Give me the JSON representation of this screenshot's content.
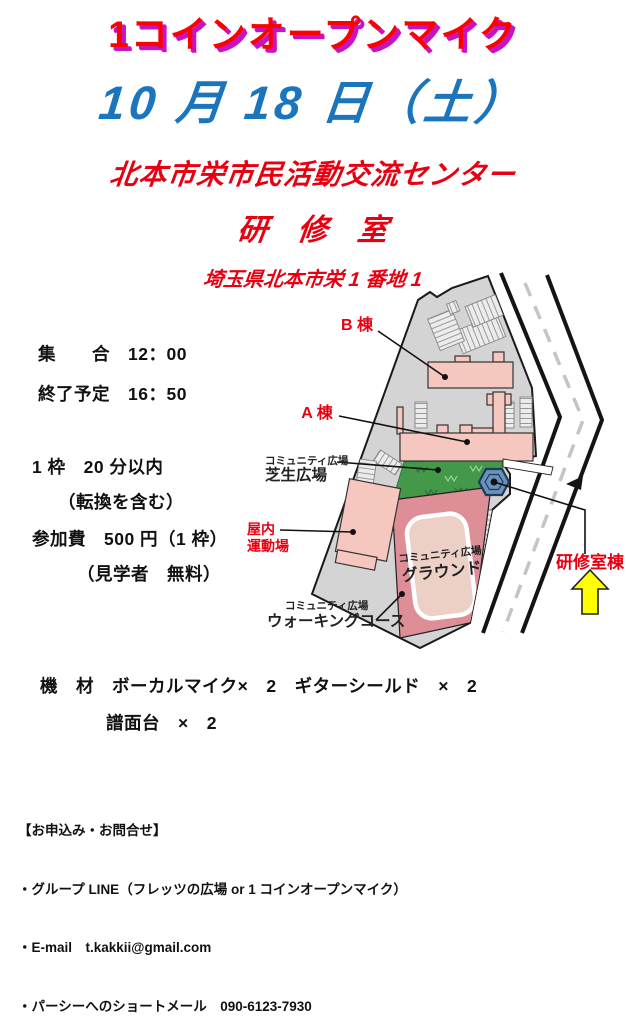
{
  "header": {
    "title": "1コインオープンマイク",
    "date": "10 月 18 日（土）",
    "venue": "北本市栄市民活動交流センター",
    "room": "研　修　室",
    "address": "埼玉県北本市栄 1 番地 1",
    "title_color": "#ff0000",
    "title_outline_color": "#c513c5",
    "date_color": "#1b75bc",
    "red_text_color": "#e60012"
  },
  "details": [
    "集　　合　12：00",
    "終了予定　16：50",
    "1 枠　20 分以内",
    "（転換を含む）",
    "参加費　500 円（1 枠）",
    "（見学者　無料）"
  ],
  "equipment": [
    "機　材　ボーカルマイク×　2　ギターシールド　×　2",
    "譜面台　×　2"
  ],
  "contact": {
    "heading": "【お申込み・お問合せ】",
    "items": [
      "・グループ LINE（フレッツの広場 or 1 コインオープンマイク）",
      "・E-mail　t.kakkii@gmail.com",
      "・パーシーへのショートメール　090-6123-7930"
    ]
  },
  "map": {
    "labels": {
      "building_b": "B 棟",
      "building_a": "A 棟",
      "lawn_small": "コミュニティ広場",
      "lawn": "芝生広場",
      "indoor1": "屋内",
      "indoor2": "運動場",
      "ground_small": "コミュニティ広場",
      "ground": "グラウンド",
      "walking_small": "コミュニティ広場",
      "walking": "ウォーキングコース",
      "training": "研修室棟"
    },
    "colors": {
      "site": "#d4d4d4",
      "building": "#f6c7bf",
      "lawn": "#44984a",
      "training_hex": "#6b92bd",
      "ground_outer": "#dd8e96",
      "ground_inner": "#ecd0c6",
      "arrow": "#ffff00",
      "label_red": "#e60012"
    }
  }
}
